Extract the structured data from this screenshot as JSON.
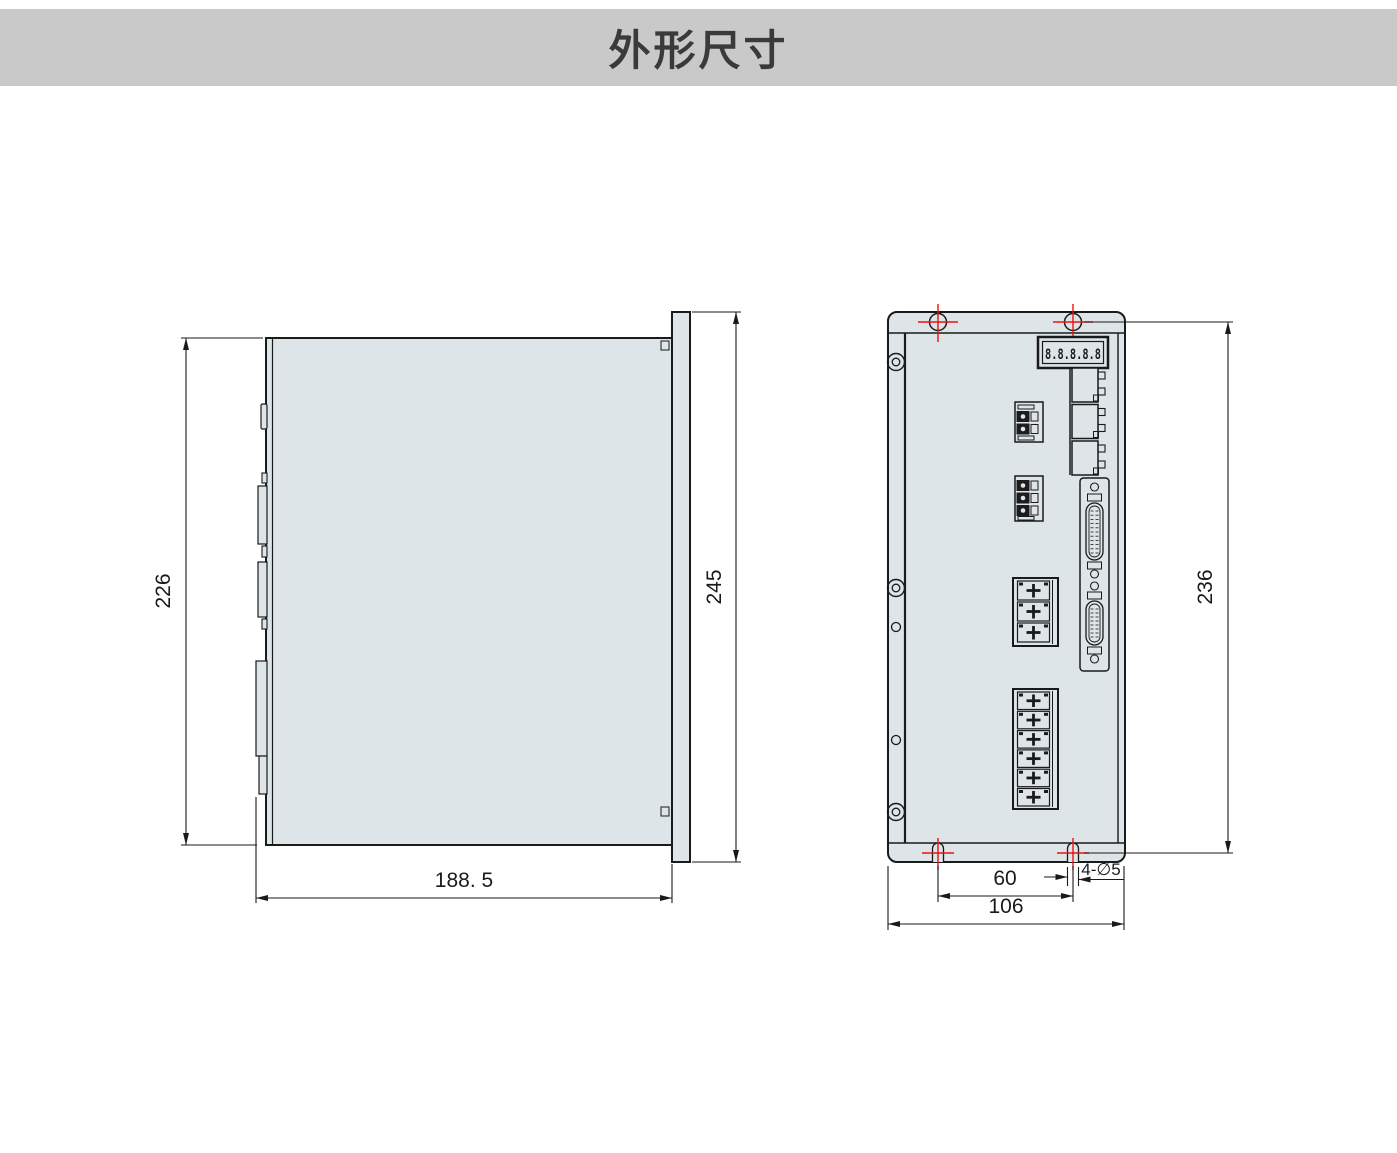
{
  "header": {
    "title": "外形尺寸"
  },
  "side_view": {
    "dim_body_height": "226",
    "dim_flange_height": "245",
    "dim_depth": "188. 5"
  },
  "front_view": {
    "dim_mounting_height": "236",
    "dim_hole_spacing": "60",
    "dim_width": "106",
    "hole_callout": "4-∅5",
    "seven_segment_display": "8.8.8.8.8"
  },
  "colors": {
    "header_bg": "#c9c9c9",
    "title_text": "#3a3a3a",
    "panel_fill": "#dde5e8",
    "line": "#1a1a1a",
    "marker_red": "#ee1111",
    "pin_dark": "#1c1c1c"
  }
}
